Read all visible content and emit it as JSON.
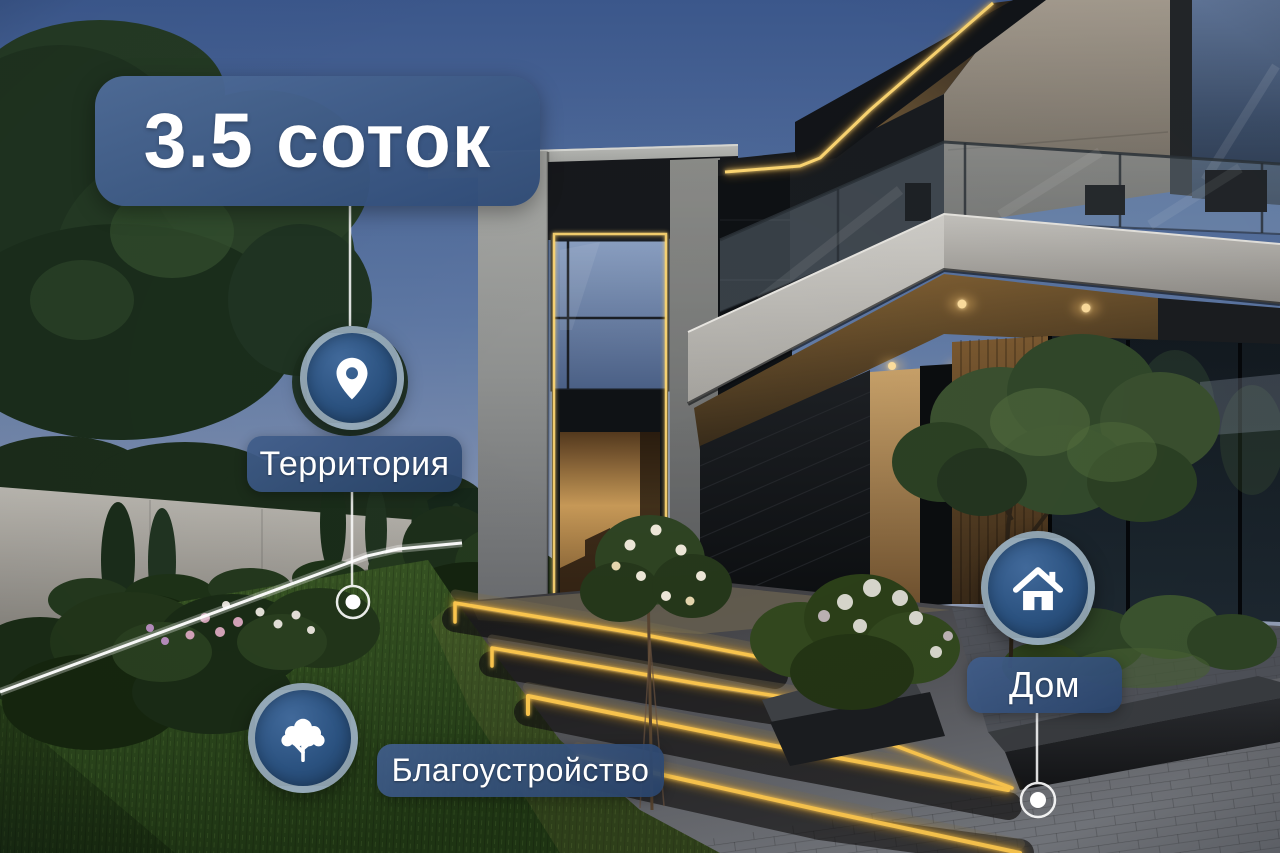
{
  "overlay": {
    "area_badge": {
      "label": "3.5 соток"
    },
    "markers": [
      {
        "id": "territory",
        "icon": "location-pin-icon",
        "label": "Территория"
      },
      {
        "id": "landscaping",
        "icon": "tree-icon",
        "label": "Благоустройство"
      },
      {
        "id": "house",
        "icon": "house-icon",
        "label": "Дом"
      }
    ],
    "colors": {
      "badge_blue": "#3b5c8f",
      "pill_blue": "#31507d",
      "marker_fill": "#2b5280",
      "marker_ring": "rgba(227,233,223,0.55)",
      "connector_white": "rgba(255,255,255,0.85)",
      "boundary_white": "rgba(255,255,255,0.95)",
      "led_accent": "#ffd873",
      "dusk_sky": "#5f79a5"
    }
  }
}
